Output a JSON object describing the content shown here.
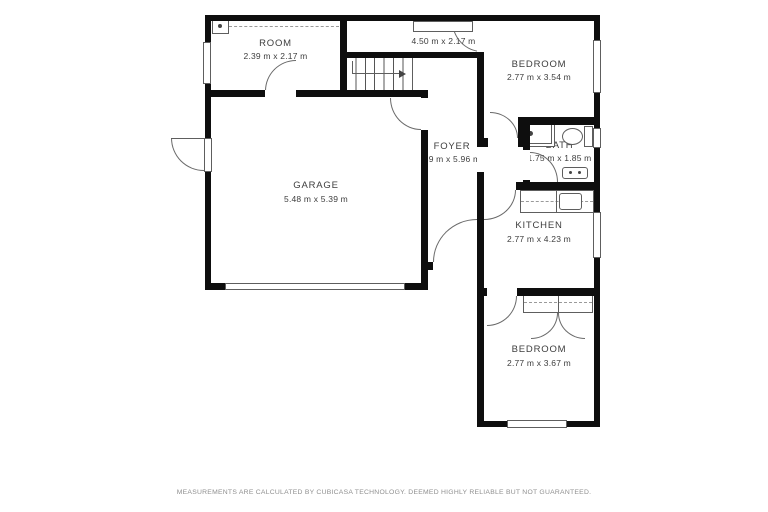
{
  "floorplan": {
    "rooms": [
      {
        "name": "ROOM",
        "dims": "2.39 m x 2.17 m"
      },
      {
        "name": "W.I.C.",
        "dims": "4.50 m x 2.17 m"
      },
      {
        "name": "BEDROOM",
        "dims": "2.77 m x 3.54 m"
      },
      {
        "name": "BATH",
        "dims": "1.75 m x 1.85 m"
      },
      {
        "name": "FOYER",
        "dims": "89 m x 5.96 m"
      },
      {
        "name": "GARAGE",
        "dims": "5.48 m x 5.39 m"
      },
      {
        "name": "KITCHEN",
        "dims": "2.77 m x 4.23 m"
      },
      {
        "name": "BEDROOM",
        "dims": "2.77 m x 3.67 m"
      }
    ],
    "footer": {
      "disclaimer": "MEASUREMENTS ARE CALCULATED BY CUBICASA TECHNOLOGY. DEEMED HIGHLY RELIABLE BUT NOT GUARANTEED."
    },
    "colors": {
      "wall": "#0e0e0e",
      "symbol_line": "#5e5e5e",
      "label_text": "#3d3d3d",
      "disclaimer_text": "#8f8f8f",
      "background": "#ffffff"
    }
  }
}
